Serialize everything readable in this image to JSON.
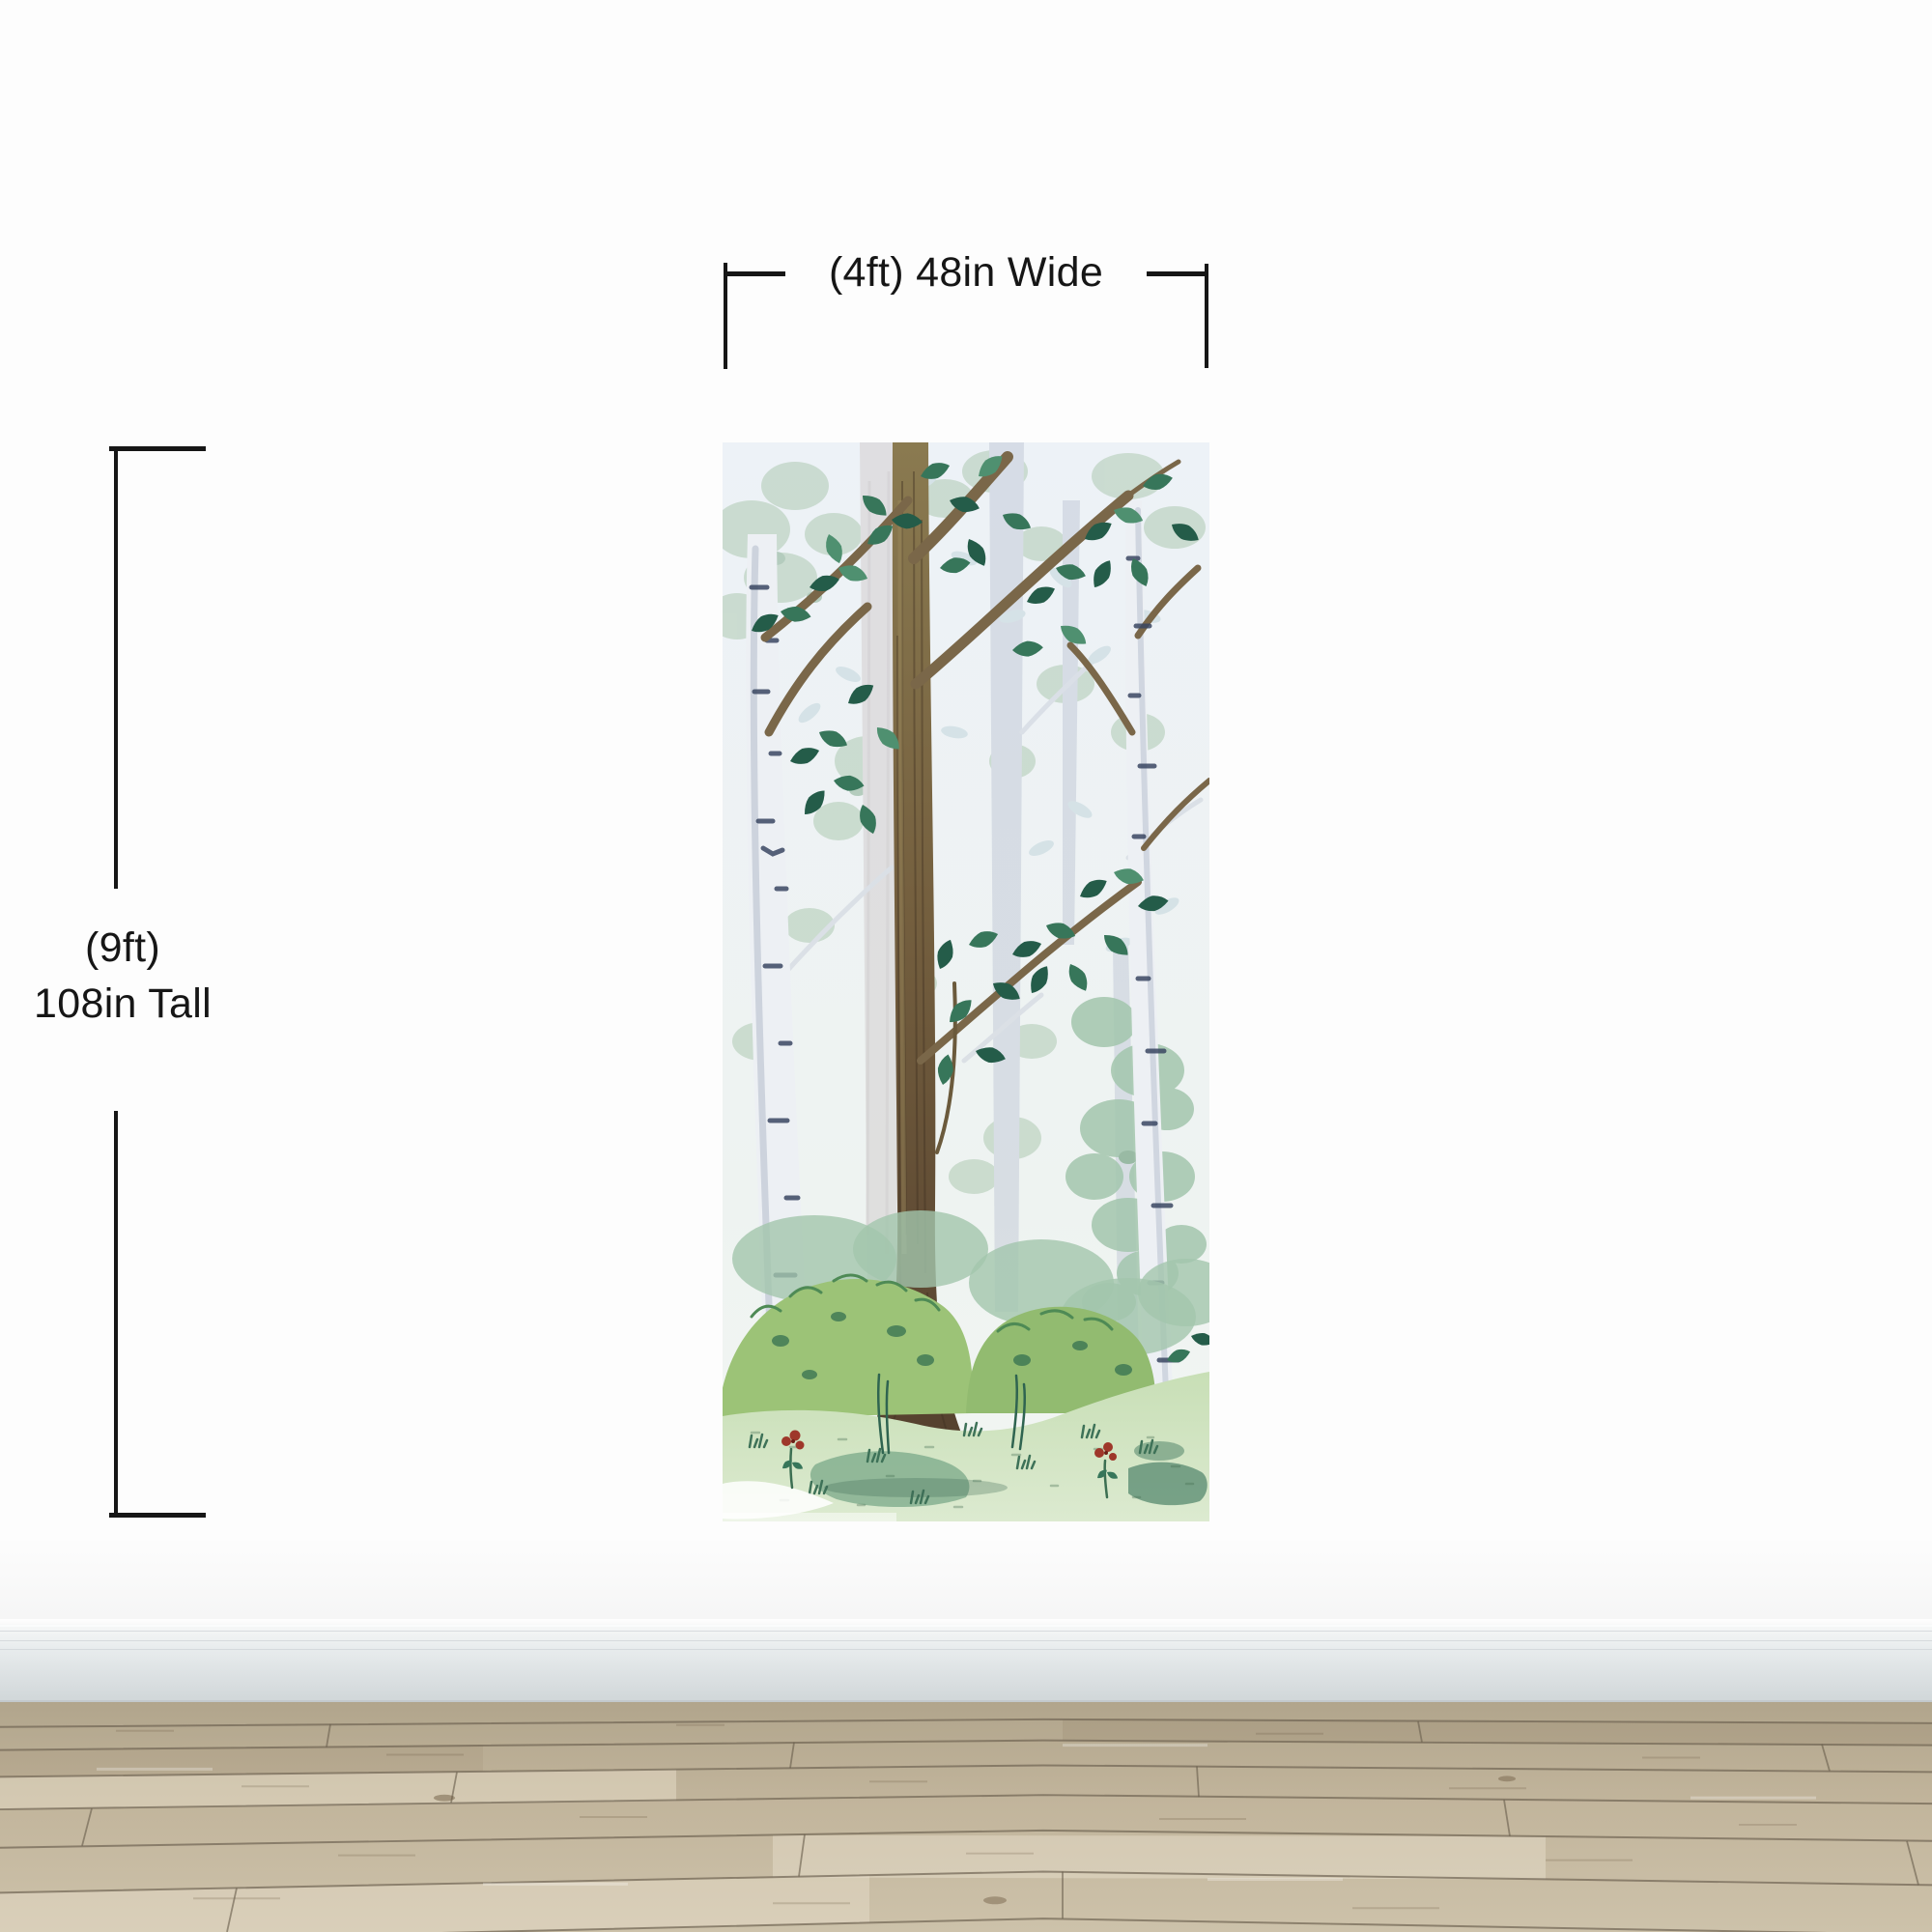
{
  "dimensions": {
    "width_label": "(4ft) 48in Wide",
    "height_line1": "(9ft)",
    "height_line2": "108in Tall"
  },
  "colors": {
    "wall": "#fdfdfd",
    "annotation": "#161616",
    "baseboard_light": "#f6f7f7",
    "baseboard_dark": "#dadfe1",
    "baseboard_edge": "#c3c9cc",
    "floor_near": "#cdc2aa",
    "floor_mid": "#c2b59c",
    "floor_far": "#b1a58c",
    "floor_seam": "#6f6452",
    "mural_sky": "#edf2f7",
    "mural_fade_foliage": "#b4cdb8",
    "mural_fade_trunk": "#d6d2d3",
    "mural_birch": "#edf0f4",
    "mural_birch_mark": "#3a4662",
    "mural_trunk": "#7a6749",
    "mural_leaf_dark": "#245c49",
    "mural_bush": "#9cc377",
    "mural_grass": "#c8dfb6",
    "mural_flower": "#9e372a"
  }
}
